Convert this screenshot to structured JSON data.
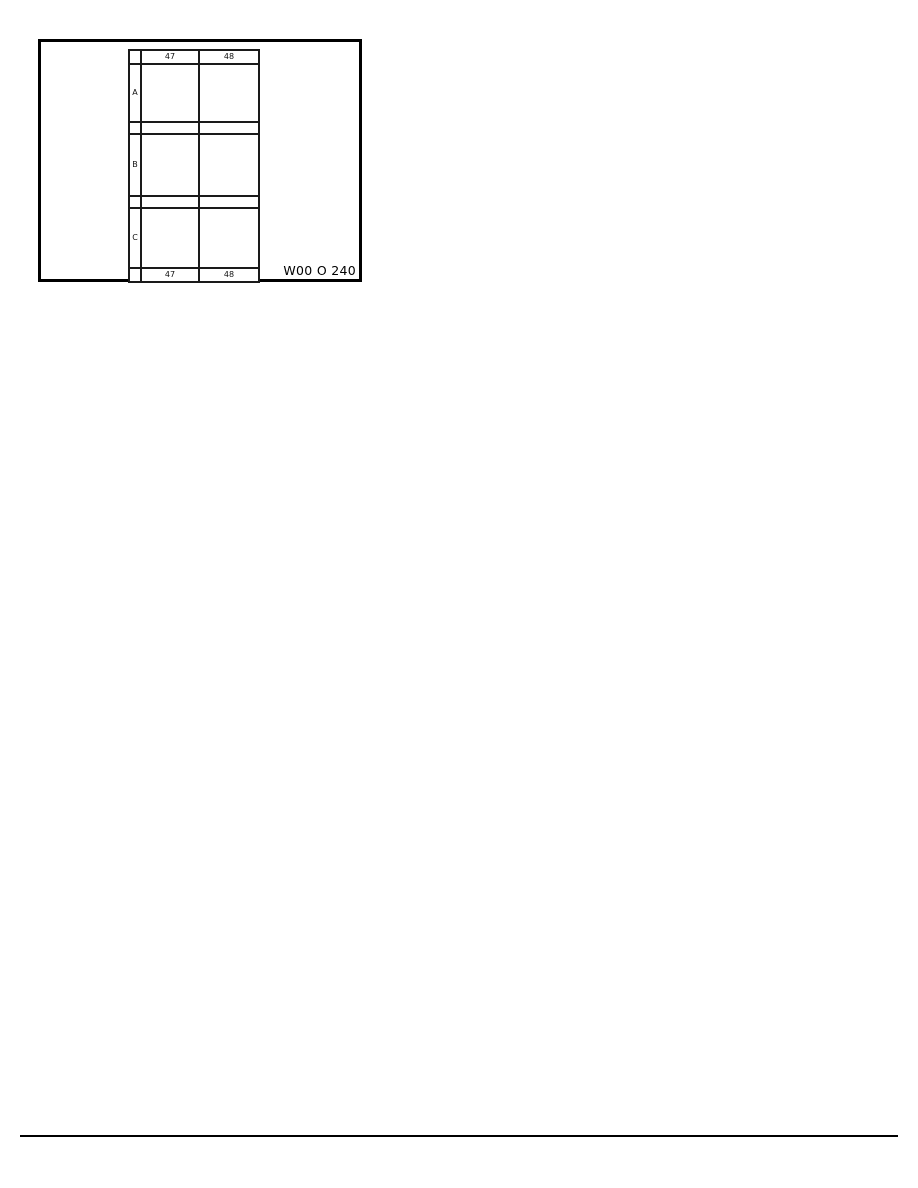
{
  "page": {
    "background_color": "#ffffff",
    "line_color": "#000000"
  },
  "figure": {
    "code": "W00 O 240",
    "grid": {
      "col_headers": [
        "47",
        "48"
      ],
      "row_labels": [
        "A",
        "B",
        "C"
      ],
      "col_footers": [
        "47",
        "48"
      ]
    }
  }
}
